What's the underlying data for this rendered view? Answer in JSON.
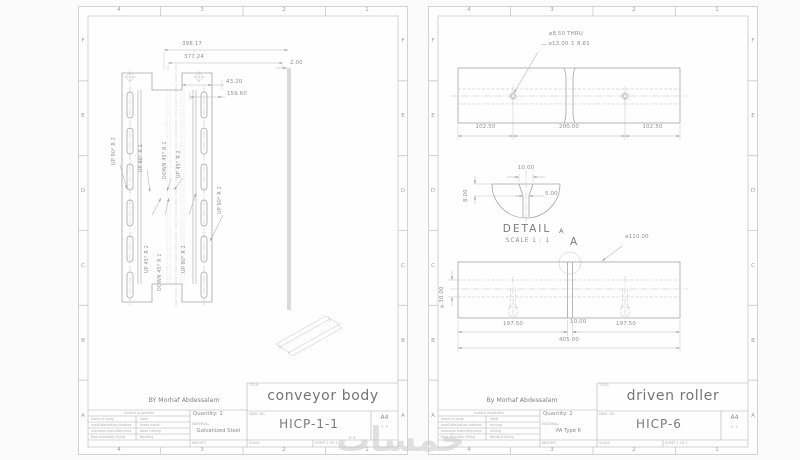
{
  "watermark": {
    "text": "خمسات"
  },
  "sheets": [
    {
      "grid": {
        "cols": [
          "4",
          "3",
          "2",
          "1"
        ],
        "rows": [
          "F",
          "E",
          "D",
          "C",
          "B",
          "A"
        ]
      },
      "author": "BY Morhaf Abdessalam",
      "dims": {
        "overall": "398.17",
        "flat": "377.24",
        "offset": "43.20",
        "pitch": "159.60",
        "thickness": "2.00"
      },
      "bend_notes": [
        "UP 90° R 2",
        "UP 90° R 2",
        "DOWN 45° R 2",
        "UP 45° R 2",
        "UP 90° R 2",
        "UP 45° R 2",
        "DOWN 45° R 2",
        "UP 90° R 2"
      ],
      "tb": {
        "title_label": "TITLE:",
        "title": "conveyor body",
        "dwg_label": "DWG. NO.",
        "dwg": "HICP-1-1",
        "size": "A4",
        "size_marks": "✳ ✳",
        "qty": "Quantity: 1",
        "material_label": "MATERIAL:",
        "material": "Galvanized Steel",
        "table": {
          "header": "surface properties",
          "rows": [
            {
              "label": "blank or body",
              "value": "steel"
            },
            {
              "label": "used fabrication method",
              "value": "sheet metal"
            },
            {
              "label": "unknown manufacturing",
              "value": "laser cutting"
            },
            {
              "label": "final assembly fixing",
              "value": "bending"
            }
          ]
        },
        "weight": "WEIGHT:",
        "scale": "SCALE",
        "sheet": "SHEET 1 OF 1"
      }
    },
    {
      "grid": {
        "cols": [
          "4",
          "3",
          "2",
          "1"
        ],
        "rows": [
          "F",
          "E",
          "D",
          "C",
          "B",
          "A"
        ]
      },
      "author": "By Morhaf Abdessalam",
      "callout": {
        "l1": "⌀8.50 THRU",
        "l2": "⌴ ⌀13.00 ↧ 8.61"
      },
      "dims": {
        "a": "102.50",
        "b": "200.00",
        "c": "102.50",
        "d110": "⌀110.00",
        "d30": "⌀30.00",
        "p1": "197.50",
        "slot": "10.00",
        "p2": "197.50",
        "overall": "405.00"
      },
      "detail": {
        "title": "DETAIL",
        "ref": "A",
        "scale": "SCALE 1 : 1",
        "w": "10.00",
        "inner": "5.00",
        "depth": "8.00",
        "marker": "A"
      },
      "tb": {
        "title_label": "TITLE:",
        "title": "driven roller",
        "dwg_label": "DWG. NO.",
        "dwg": "HICP-6",
        "size": "A4",
        "size_marks": "✳ ✳",
        "qty": "Quantity: 2",
        "material_label": "MATERIAL:",
        "material": "PA Type 6",
        "table": {
          "header": "surface properties",
          "rows": [
            {
              "label": "blank or body",
              "value": "shaft"
            },
            {
              "label": "used fabrication method",
              "value": "turning"
            },
            {
              "label": "unknown manufacturing",
              "value": "milling"
            },
            {
              "label": "final assembly fixing",
              "value": "fitting & fixing"
            }
          ]
        },
        "weight": "WEIGHT:",
        "scale": "SCALE",
        "sheet": "SHEET 1 OF 1"
      }
    }
  ]
}
